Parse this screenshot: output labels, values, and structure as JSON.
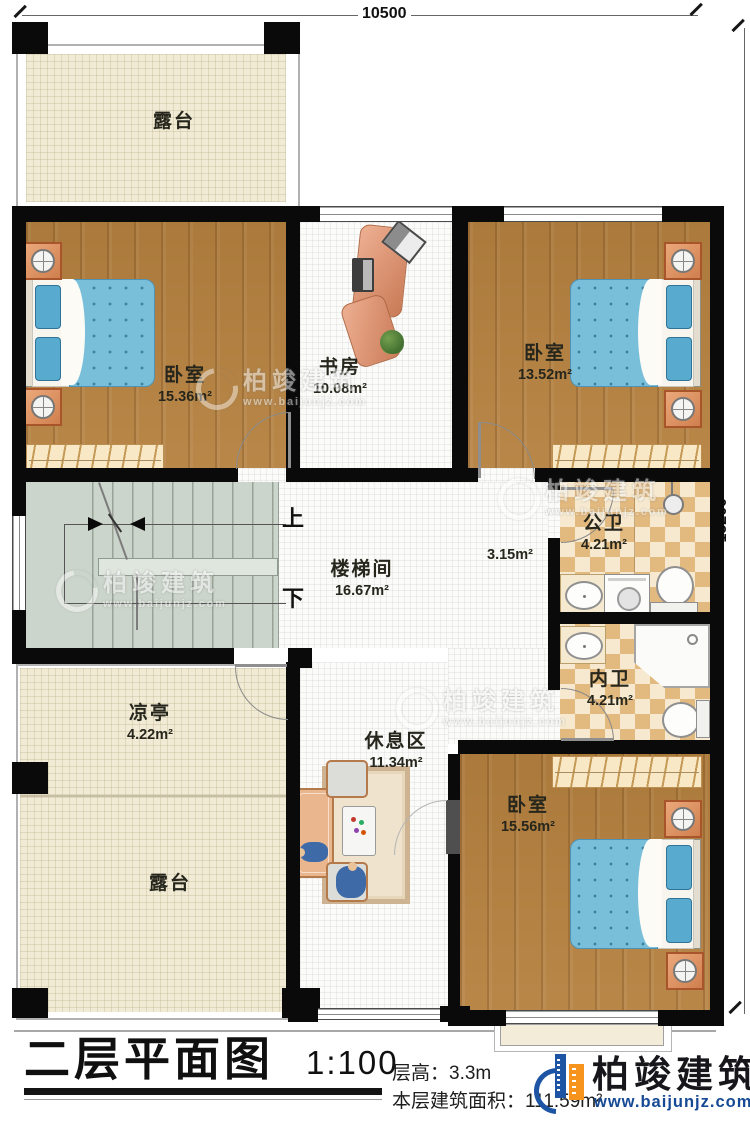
{
  "title": {
    "main": "二层平面图",
    "scale": "1:100",
    "floor_height": "层高：3.3m",
    "floor_area": "本层建筑面积：111.59m²"
  },
  "dimensions": {
    "width": "10500",
    "height": "15200"
  },
  "stairs": {
    "up": "上",
    "down": "下"
  },
  "rooms": {
    "terrace_top": {
      "name": "露台"
    },
    "bedroom_1": {
      "name": "卧室",
      "area": "15.36m²"
    },
    "study": {
      "name": "书房",
      "area": "10.08m²"
    },
    "bedroom_2": {
      "name": "卧室",
      "area": "13.52m²"
    },
    "stairwell": {
      "name": "楼梯间",
      "area": "16.67m²"
    },
    "corridor": {
      "area": "3.15m²"
    },
    "public_bath": {
      "name": "公卫",
      "area": "4.21m²"
    },
    "private_bath": {
      "name": "内卫",
      "area": "4.21m²"
    },
    "bedroom_3": {
      "name": "卧室",
      "area": "15.56m²"
    },
    "pavilion": {
      "name": "凉亭",
      "area": "4.22m²"
    },
    "terrace_bottom": {
      "name": "露台"
    },
    "rest_area": {
      "name": "休息区",
      "area": "11.34m²"
    }
  },
  "brand": {
    "name": "柏竣建筑",
    "url": "www.baijunjz.com"
  },
  "watermark": {
    "name": "柏竣建筑",
    "url": "www.baijunjz.com"
  },
  "colors": {
    "wall": "#0a0a0a",
    "wood_floor": "#b5813f",
    "terrace_floor": "#f1ebd6",
    "tile_floor": "#fbfbf9",
    "stair_floor": "#ccd5cb",
    "bath_checker": "#e2b97f",
    "bed": "#79bfda",
    "desk": "#d98d70",
    "logo_blue": "#1e54a4",
    "logo_orange": "#f7941d",
    "url_blue": "#164a94"
  }
}
